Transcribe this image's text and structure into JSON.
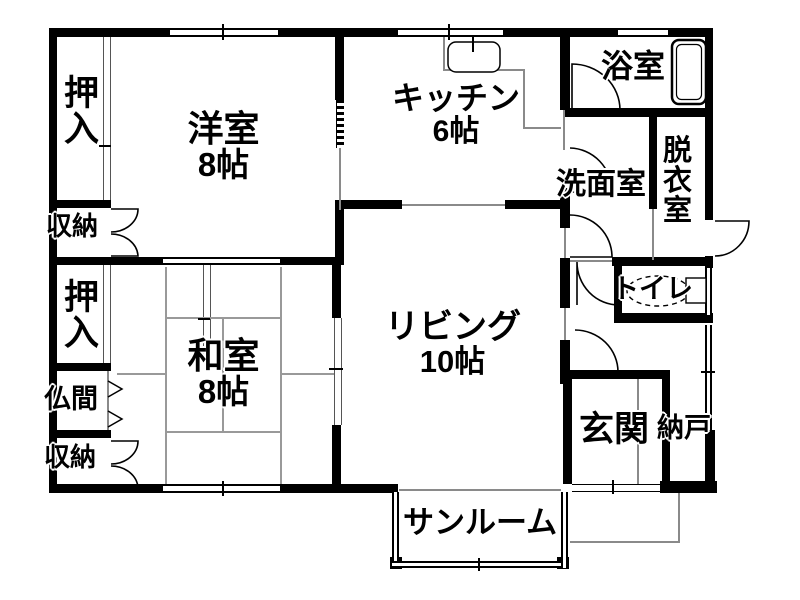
{
  "title": "間取り図",
  "colors": {
    "wall": "#000000",
    "thin_line": "#8a8a8a",
    "tatami_line": "#999999",
    "background": "#ffffff"
  },
  "rooms": {
    "oshiire_top": {
      "label": "押入"
    },
    "yoshitsu": {
      "label": "洋室",
      "size": "8帖"
    },
    "kitchen": {
      "label": "キッチン",
      "size": "6帖"
    },
    "yokushitsu": {
      "label": "浴室"
    },
    "shuno_top": {
      "label": "収納"
    },
    "senmenshitsu": {
      "label": "洗面室"
    },
    "datsuishitsu": {
      "label": "脱衣室"
    },
    "oshiire_bottom": {
      "label": "押入"
    },
    "washitsu": {
      "label": "和室",
      "size": "8帖"
    },
    "living": {
      "label": "リビング",
      "size": "10帖"
    },
    "toilet": {
      "label": "トイレ"
    },
    "butsuma": {
      "label": "仏間"
    },
    "shuno_bottom": {
      "label": "収納"
    },
    "genkan": {
      "label": "玄関"
    },
    "nando": {
      "label": "納戸"
    },
    "sunroom": {
      "label": "サンルーム"
    }
  },
  "fixtures": {
    "bathtub": "bathtub-icon",
    "kitchen_sink": "kitchen-sink-icon",
    "toilet_bowl": "toilet-bowl-icon"
  }
}
